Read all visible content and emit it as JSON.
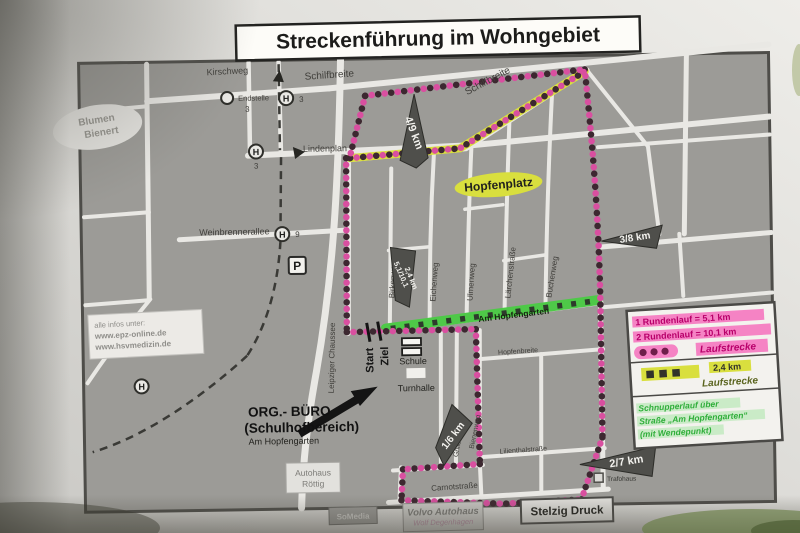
{
  "title": "Streckenführung im Wohngebiet",
  "colors": {
    "route_pink": "#d94fa0",
    "route_dark_dot": "#3c2830",
    "route_yellow": "#d9df3e",
    "route_green": "#4ec948",
    "legend_magenta": "#cc0077",
    "map_gray": "#9c9b97",
    "street_white": "#e9e8e4"
  },
  "info_box": {
    "heading": "alle infos unter:",
    "url1": "www.epz-online.de",
    "url2": "www.hsvmedizin.de"
  },
  "legend": {
    "round1": "1 Rundenlauf = 5,1 km",
    "round2": "2 Rundenlauf = 10,1 km",
    "pink_label": "Laufstrecke",
    "yellow_distance": "2,4 km",
    "yellow_label": "Laufstrecke",
    "green_line1": "Schnupperlauf über",
    "green_line2": "Straße „Am Hopfengarten“",
    "green_line3": "(mit Wendepunkt)"
  },
  "markers": {
    "top": "4/9 km",
    "right": "3/8 km",
    "bottom_left": "1/6 km",
    "bottom_right": "2/7 km",
    "center_line1": "5,1/10,1",
    "center_line2": "2,4 km",
    "start": "Start",
    "ziel": "Ziel"
  },
  "streets": {
    "kirschweg": "Kirschweg",
    "schilfbreite_left": "Schilfbreite",
    "schilfbreite_right": "Schilfbreite",
    "lindenplan": "Lindenplan",
    "weinbrennerallee": "Weinbrennerallee",
    "leipziger_chaussee": "Leipziger Chaussee",
    "birkenweg": "Birkenweg",
    "eichenweg": "Eichenweg",
    "ulmenweg": "Ulmenweg",
    "laerchenstrasse": "Lärchenstraße",
    "buchenweg": "Buchenweg",
    "am_hopfengarten": "Am Hopfengarten",
    "hopfenbreite": "Hopfenbreite",
    "lilienthalstrasse": "Lilienthalstraße",
    "grillenstieg": "Grillenstieg",
    "bienenweg": "Bienenweg",
    "carnotstrasse": "Carnotstraße"
  },
  "places": {
    "blumen1": "Blumen",
    "blumen2": "Bienert",
    "hopfenplatz": "Hopfenplatz",
    "endstelle": "Endstelle",
    "tram3a": "3",
    "tram3b": "3",
    "tram3c": "3",
    "tram9": "9",
    "parking": "P",
    "h": "H",
    "schule": "Schule",
    "turnhalle": "Turnhalle",
    "org1": "ORG.- BÜRO",
    "org2": "(Schulhofbereich)",
    "org3": "Am Hopfengarten",
    "autohaus1": "Autohaus",
    "autohaus2": "Röttig",
    "somedia": "SoMedia",
    "volvo1": "Volvo Autohaus",
    "volvo2": "Wolf Degenhagen",
    "stelzig": "Stelzig Druck",
    "trafohaus": "Trafohaus"
  }
}
